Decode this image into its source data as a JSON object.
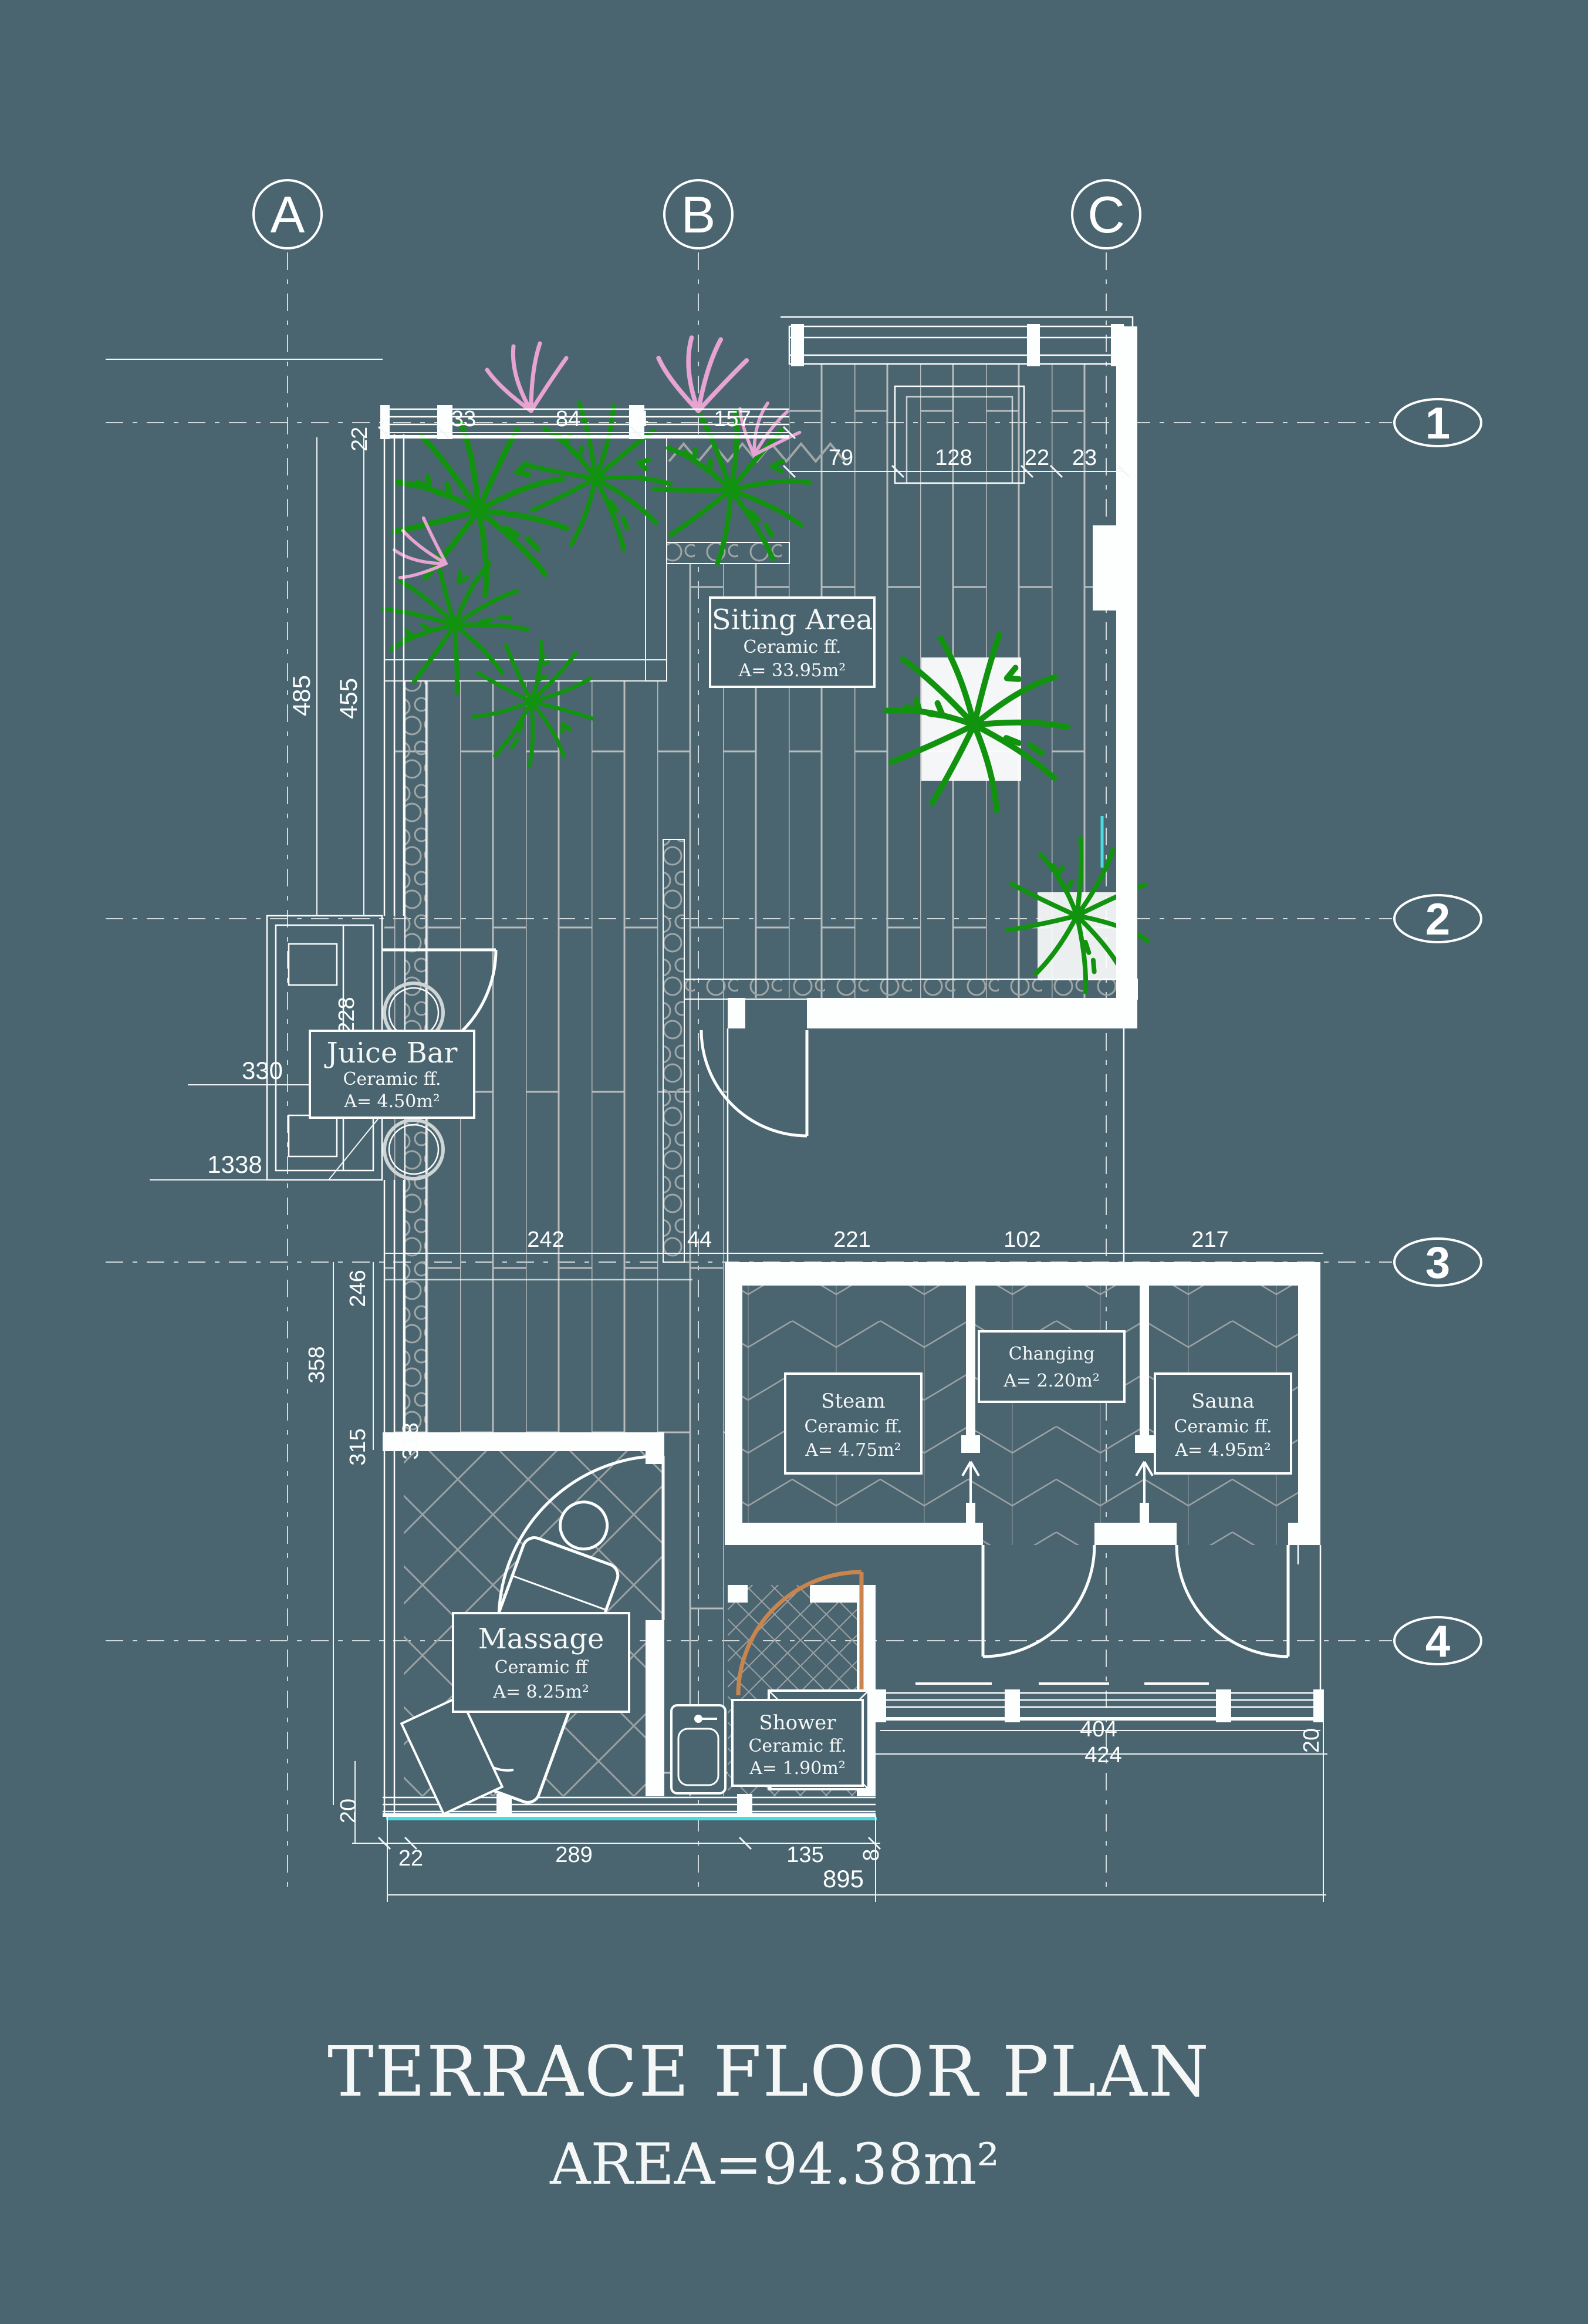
{
  "title": {
    "line1": "TERRACE FLOOR PLAN",
    "line2": "AREA=94.38m²"
  },
  "grid": {
    "columns": [
      "A",
      "B",
      "C"
    ],
    "rows": [
      "1",
      "2",
      "3",
      "4"
    ]
  },
  "rooms": {
    "siting": {
      "name": "Siting Area",
      "floor": "Ceramic ff.",
      "area": "A= 33.95m²"
    },
    "juice": {
      "name": "Juice Bar",
      "floor": "Ceramic ff.",
      "area": "A= 4.50m²"
    },
    "steam": {
      "name": "Steam",
      "floor": "Ceramic ff.",
      "area": "A= 4.75m²"
    },
    "changing": {
      "name": "Changing",
      "area": "A= 2.20m²"
    },
    "sauna": {
      "name": "Sauna",
      "floor": "Ceramic ff.",
      "area": "A= 4.95m²"
    },
    "massage": {
      "name": "Massage",
      "floor": "Ceramic ff",
      "area": "A= 8.25m²"
    },
    "shower": {
      "name": "Shower",
      "floor": "Ceramic ff.",
      "area": "A= 1.90m²"
    }
  },
  "dims": {
    "top_vert": "22",
    "top_left_row": [
      "33",
      "84",
      "4",
      "157"
    ],
    "top_right_row": [
      "79",
      "128",
      "22",
      "23"
    ],
    "left": {
      "v485": "485",
      "v455": "455",
      "h330": "330",
      "h1338": "1338",
      "v246": "246",
      "v358": "358",
      "v315": "315",
      "v318": "318",
      "v20": "20"
    },
    "mid_row": [
      "242",
      "44",
      "221",
      "102",
      "217"
    ],
    "juice": {
      "v228": "228",
      "v212": "212"
    },
    "bottom_row": {
      "d22": "22",
      "d289": "289",
      "d135": "135",
      "d8": "8",
      "d895": "895"
    },
    "bottom_right": {
      "d404": "404",
      "d424": "424",
      "v20": "20"
    }
  },
  "colors": {
    "background": "#4a6570",
    "line": "#fdfefe",
    "plank": "#b8bcbd",
    "pattern": "#9ba1a3",
    "plant": "#12930f",
    "flower": "#e7a3d2",
    "door_accent": "#c8854e",
    "cyan_accent": "#49dde2"
  }
}
